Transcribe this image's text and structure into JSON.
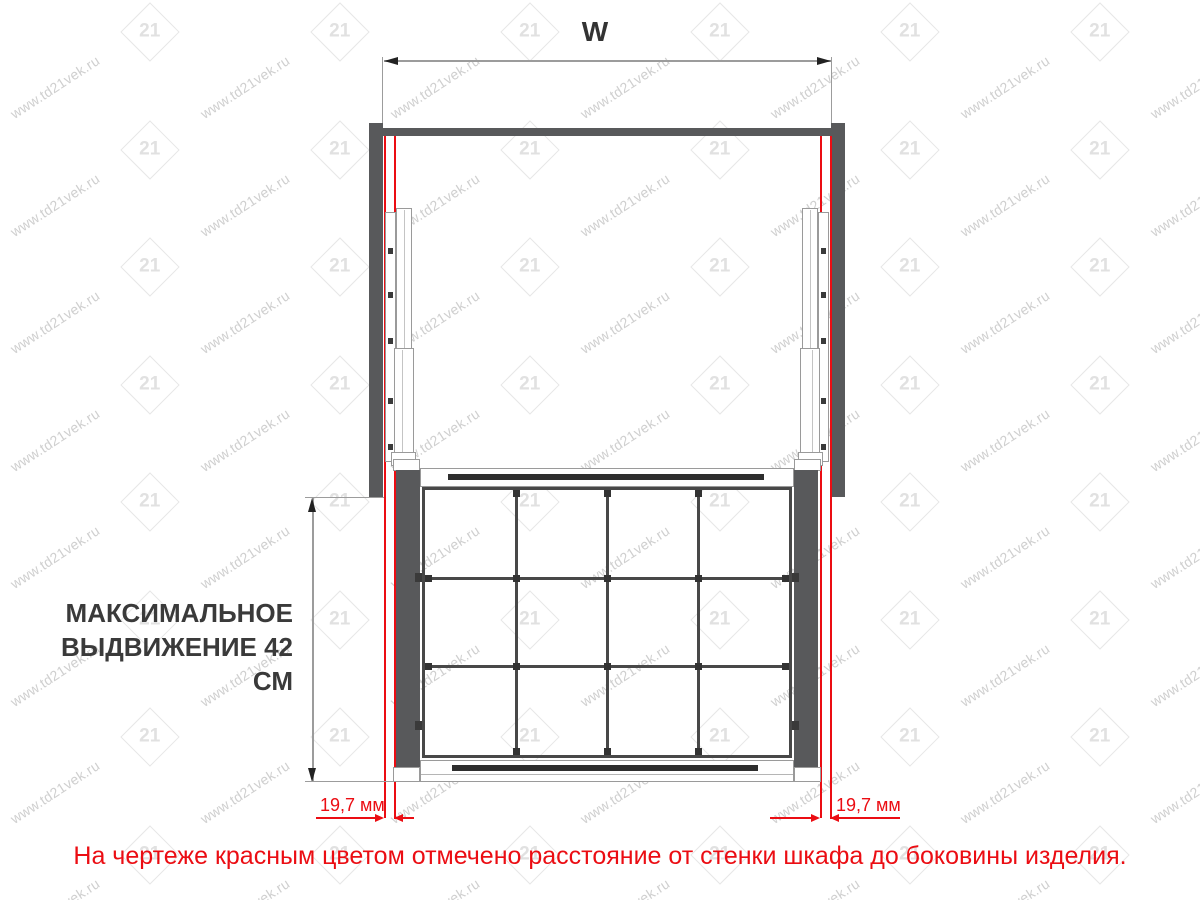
{
  "dimensions": {
    "width_label": "W",
    "clearance_left": "19,7 мм",
    "clearance_right": "19,7 мм"
  },
  "extension_note": {
    "line1": "МАКСИМАЛЬНОЕ",
    "line2": "ВЫДВИЖЕНИЕ 42 СМ"
  },
  "footnote": "На чертеже красным цветом отмечено расстояние  от стенки шкафа до боковины изделия.",
  "watermark": {
    "url": "www.td21vek.ru",
    "logo": "21"
  },
  "drawing": {
    "basket_grid": {
      "columns": 4,
      "rows": 3
    }
  },
  "colors": {
    "red": "#eb0d13",
    "panel_gray": "#58595b",
    "wire_dark": "#484848",
    "profile_light": "#9a9a9a",
    "text_dark": "#3a3a3a"
  }
}
